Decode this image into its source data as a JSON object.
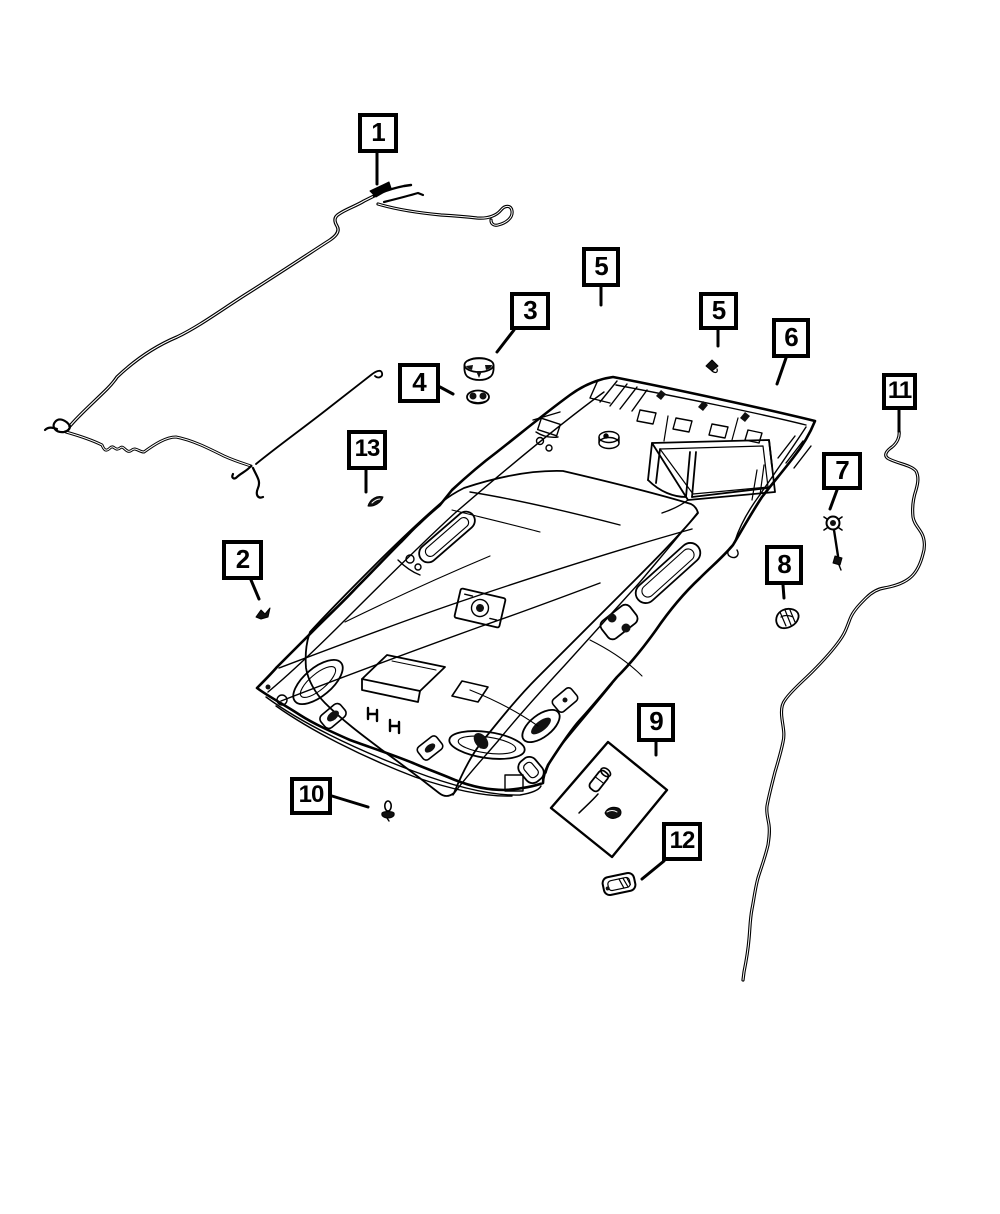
{
  "figure": {
    "kind": "exploded-parts-diagram",
    "background": "#ffffff",
    "line_color": "#000000",
    "callouts": [
      {
        "id": "1",
        "label": "1",
        "x": 358,
        "y": 113,
        "w": 40,
        "h": 40,
        "leader": [
          [
            377,
            153
          ],
          [
            377,
            184
          ]
        ]
      },
      {
        "id": "2",
        "label": "2",
        "x": 222,
        "y": 540,
        "w": 41,
        "h": 40,
        "leader": [
          [
            251,
            580
          ],
          [
            259,
            599
          ]
        ]
      },
      {
        "id": "3",
        "label": "3",
        "x": 510,
        "y": 292,
        "w": 40,
        "h": 38,
        "leader": [
          [
            514,
            330
          ],
          [
            497,
            352
          ]
        ]
      },
      {
        "id": "4",
        "label": "4",
        "x": 398,
        "y": 363,
        "w": 42,
        "h": 40,
        "leader": [
          [
            440,
            387
          ],
          [
            453,
            394
          ]
        ]
      },
      {
        "id": "5a",
        "label": "5",
        "x": 582,
        "y": 247,
        "w": 38,
        "h": 40,
        "leader": [
          [
            601,
            287
          ],
          [
            601,
            305
          ]
        ]
      },
      {
        "id": "5b",
        "label": "5",
        "x": 699,
        "y": 292,
        "w": 39,
        "h": 38,
        "leader": [
          [
            718,
            330
          ],
          [
            718,
            346
          ]
        ]
      },
      {
        "id": "6",
        "label": "6",
        "x": 772,
        "y": 318,
        "w": 38,
        "h": 40,
        "leader": [
          [
            786,
            358
          ],
          [
            777,
            384
          ]
        ]
      },
      {
        "id": "7",
        "label": "7",
        "x": 822,
        "y": 452,
        "w": 40,
        "h": 38,
        "leader": [
          [
            837,
            490
          ],
          [
            830,
            509
          ]
        ]
      },
      {
        "id": "8",
        "label": "8",
        "x": 765,
        "y": 545,
        "w": 38,
        "h": 40,
        "leader": [
          [
            783,
            585
          ],
          [
            784,
            598
          ]
        ]
      },
      {
        "id": "9",
        "label": "9",
        "x": 637,
        "y": 703,
        "w": 38,
        "h": 39,
        "leader": [
          [
            656,
            742
          ],
          [
            656,
            755
          ]
        ]
      },
      {
        "id": "10",
        "label": "10",
        "x": 290,
        "y": 777,
        "w": 42,
        "h": 38,
        "leader": [
          [
            332,
            796
          ],
          [
            368,
            807
          ]
        ]
      },
      {
        "id": "11",
        "label": "11",
        "x": 882,
        "y": 373,
        "w": 35,
        "h": 37,
        "leader": [
          [
            899,
            410
          ],
          [
            899,
            431
          ]
        ]
      },
      {
        "id": "12",
        "label": "12",
        "x": 662,
        "y": 822,
        "w": 40,
        "h": 39,
        "leader": [
          [
            664,
            861
          ],
          [
            642,
            879
          ]
        ]
      },
      {
        "id": "13",
        "label": "13",
        "x": 347,
        "y": 430,
        "w": 40,
        "h": 40,
        "leader": [
          [
            366,
            470
          ],
          [
            366,
            492
          ]
        ]
      }
    ]
  }
}
